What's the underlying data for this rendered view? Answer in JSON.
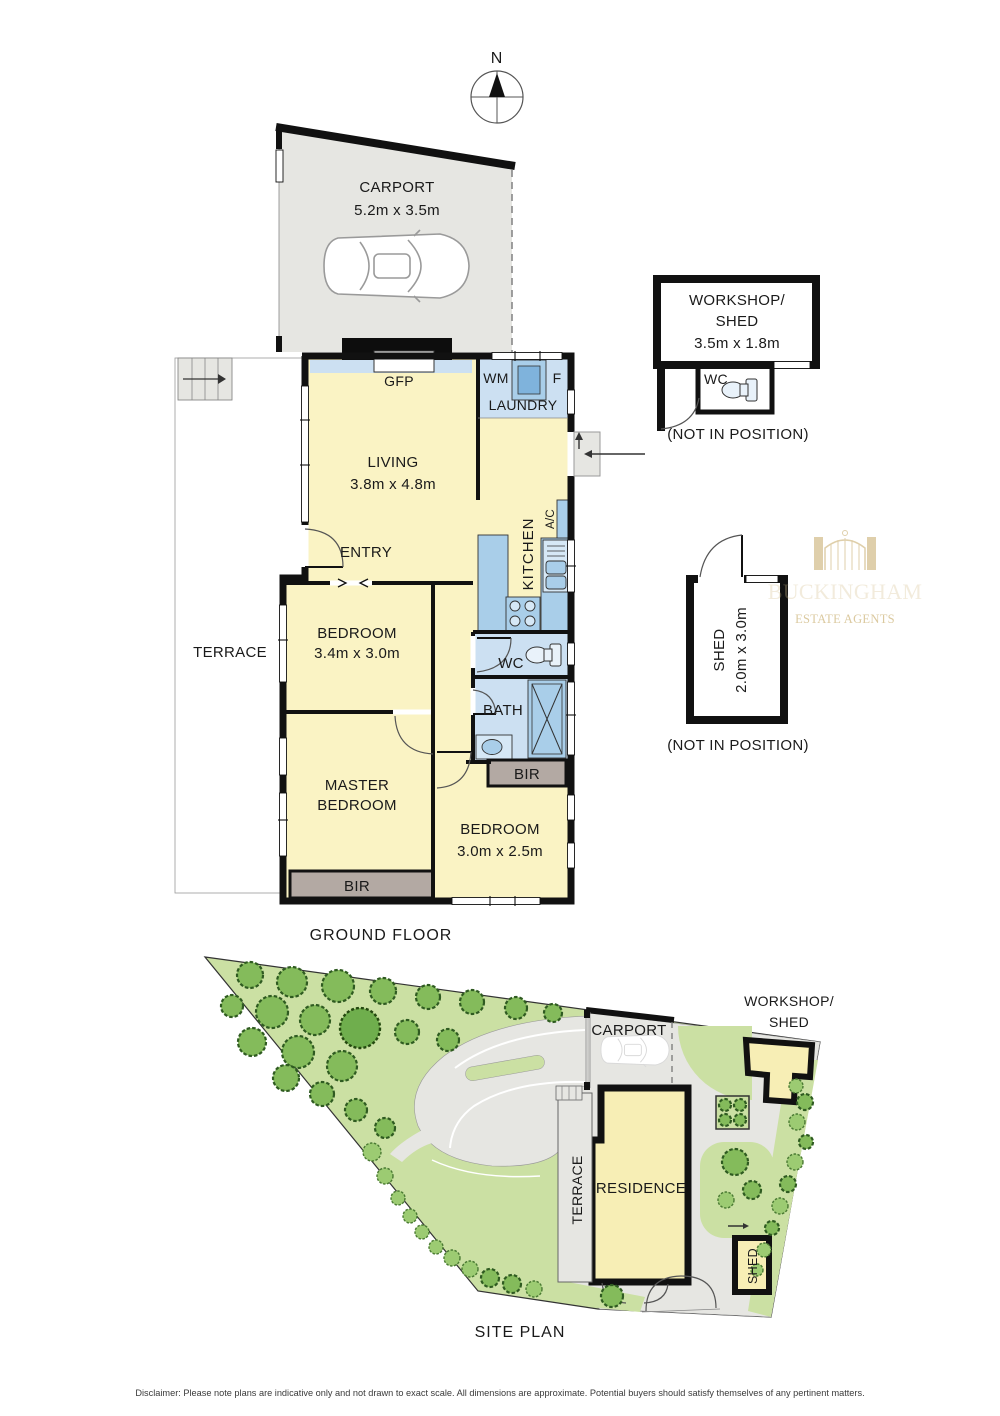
{
  "compass": {
    "north_label": "N"
  },
  "floor_plan": {
    "title": "GROUND FLOOR",
    "carport": {
      "label": "CARPORT",
      "dims": "5.2m x 3.5m"
    },
    "terrace": {
      "label": "TERRACE"
    },
    "living": {
      "label": "LIVING",
      "dims": "3.8m x 4.8m"
    },
    "gfp": {
      "label": "GFP"
    },
    "laundry": {
      "label": "LAUNDRY",
      "wm": "WM",
      "fridge": "F"
    },
    "kitchen": {
      "label": "KITCHEN"
    },
    "ac": {
      "label": "A/C"
    },
    "entry": {
      "label": "ENTRY"
    },
    "bedroom1": {
      "label": "BEDROOM",
      "dims": "3.4m x 3.0m"
    },
    "wc": {
      "label": "WC"
    },
    "bath": {
      "label": "BATH"
    },
    "bir_hall": {
      "label": "BIR"
    },
    "master_bedroom": {
      "line1": "MASTER",
      "line2": "BEDROOM"
    },
    "bir_master": {
      "label": "BIR"
    },
    "bedroom3": {
      "label": "BEDROOM",
      "dims": "3.0m x 2.5m"
    }
  },
  "workshop": {
    "line1": "WORKSHOP/",
    "line2": "SHED",
    "dims": "3.5m x 1.8m",
    "wc": "WC",
    "note": "(NOT IN POSITION)"
  },
  "shed": {
    "line1": "SHED",
    "dims": "2.0m x 3.0m",
    "note": "(NOT IN POSITION)"
  },
  "site_plan": {
    "title": "SITE PLAN",
    "carport": "CARPORT",
    "workshop_line1": "WORKSHOP/",
    "workshop_line2": "SHED",
    "residence": "RESIDENCE",
    "terrace": "TERRACE",
    "shed": "SHED"
  },
  "watermark": {
    "brand": "BUCKINGHAM",
    "tagline": "ESTATE  AGENTS"
  },
  "disclaimer": "Disclaimer: Please note plans are indicative only and not drawn to exact scale. All dimensions are approximate. Potential buyers should satisfy themselves of any pertinent matters.",
  "colors": {
    "room_fill": "#FAF3C4",
    "wet_area_fill": "#CCE0F2",
    "fixture_fill": "#A9CEE9",
    "robe_fill": "#B3A9A3",
    "paving_fill": "#E6E6E2",
    "wall": "#111111",
    "lawn": "#CBE0A3",
    "tree": "#84BB5B",
    "watermark_gold": "#D5C08F"
  }
}
